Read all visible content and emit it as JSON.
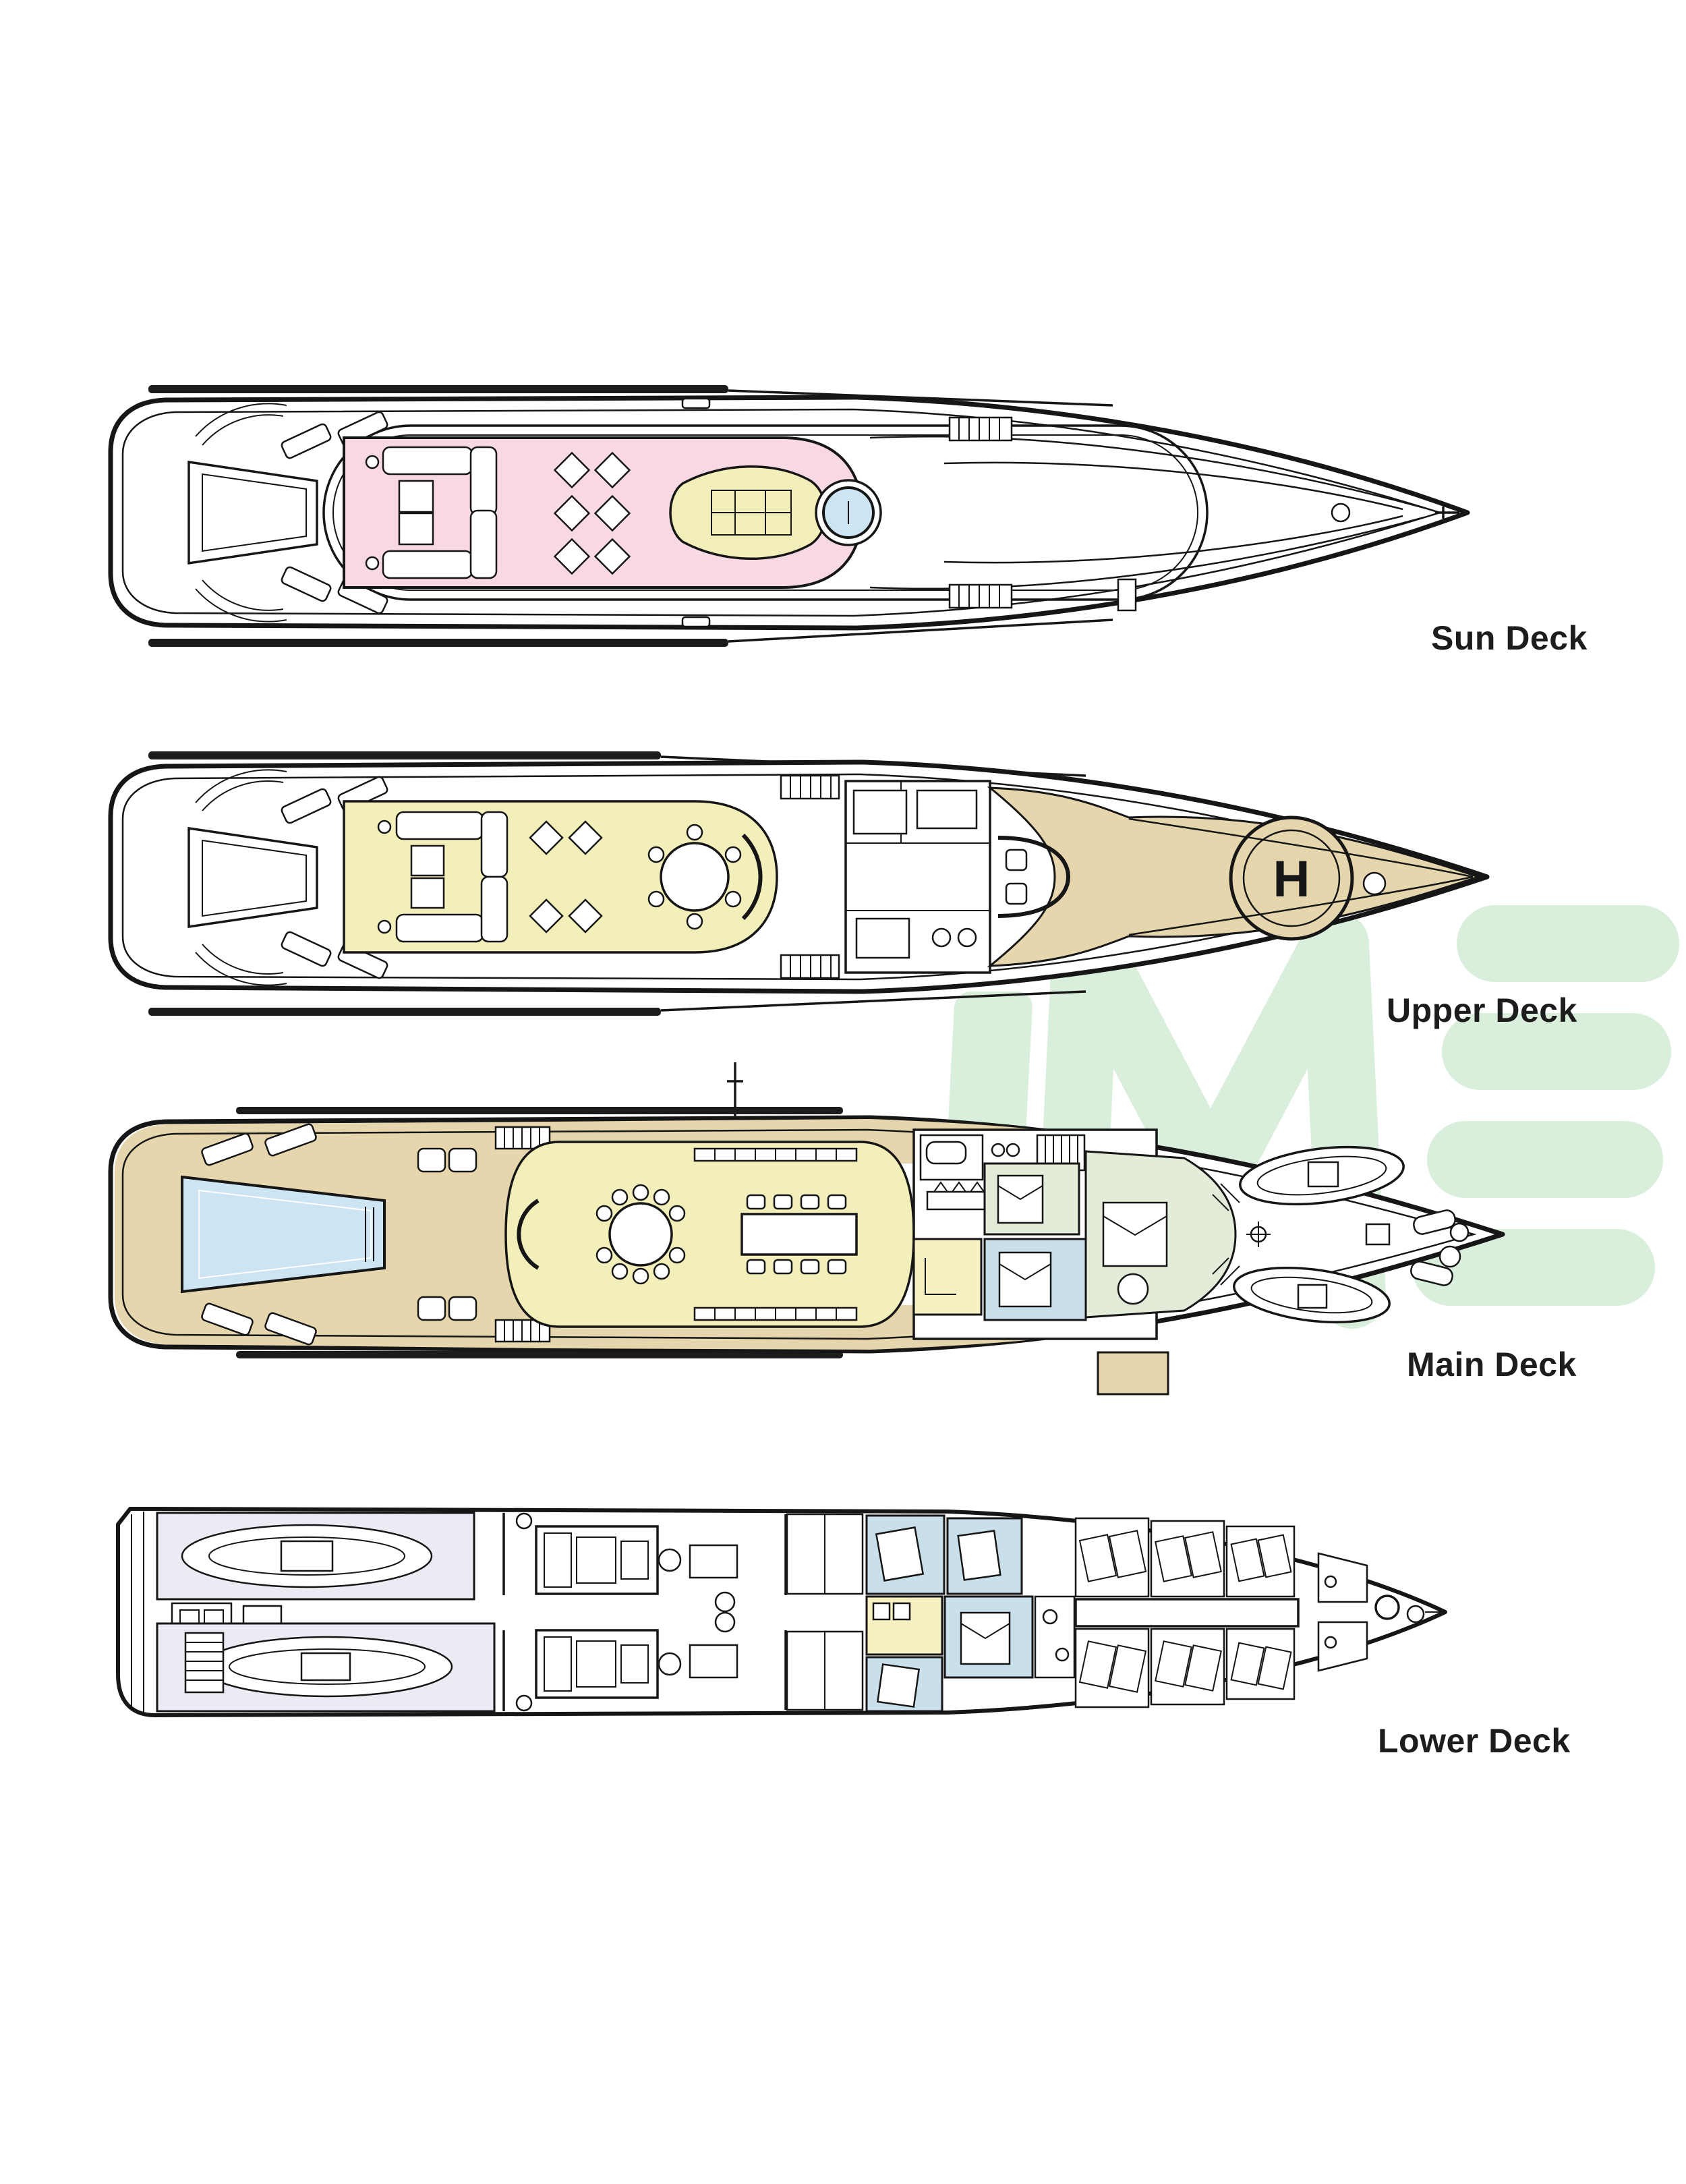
{
  "watermark": {
    "text": "IME",
    "color": "#d9efdb"
  },
  "colors": {
    "line": "#161616",
    "label": "#1d1d1d",
    "dark_bar": "#1c1c1c",
    "pink": "#f7d8e3",
    "yellow": "#f3efba",
    "tan": "#e6d6ae",
    "pool_blue": "#cde4f2",
    "cabin_blue": "#c9dfe9",
    "pale_green": "#e3ecd9",
    "pale_yellow": "#f6f0c2",
    "lavender": "#ecebf4",
    "watermark": "#d9efdb"
  },
  "decks": [
    {
      "id": "sun-deck",
      "label": "Sun Deck"
    },
    {
      "id": "upper-deck",
      "label": "Upper Deck",
      "helipad_letter": "H"
    },
    {
      "id": "main-deck",
      "label": "Main Deck"
    },
    {
      "id": "lower-deck",
      "label": "Lower Deck"
    }
  ]
}
